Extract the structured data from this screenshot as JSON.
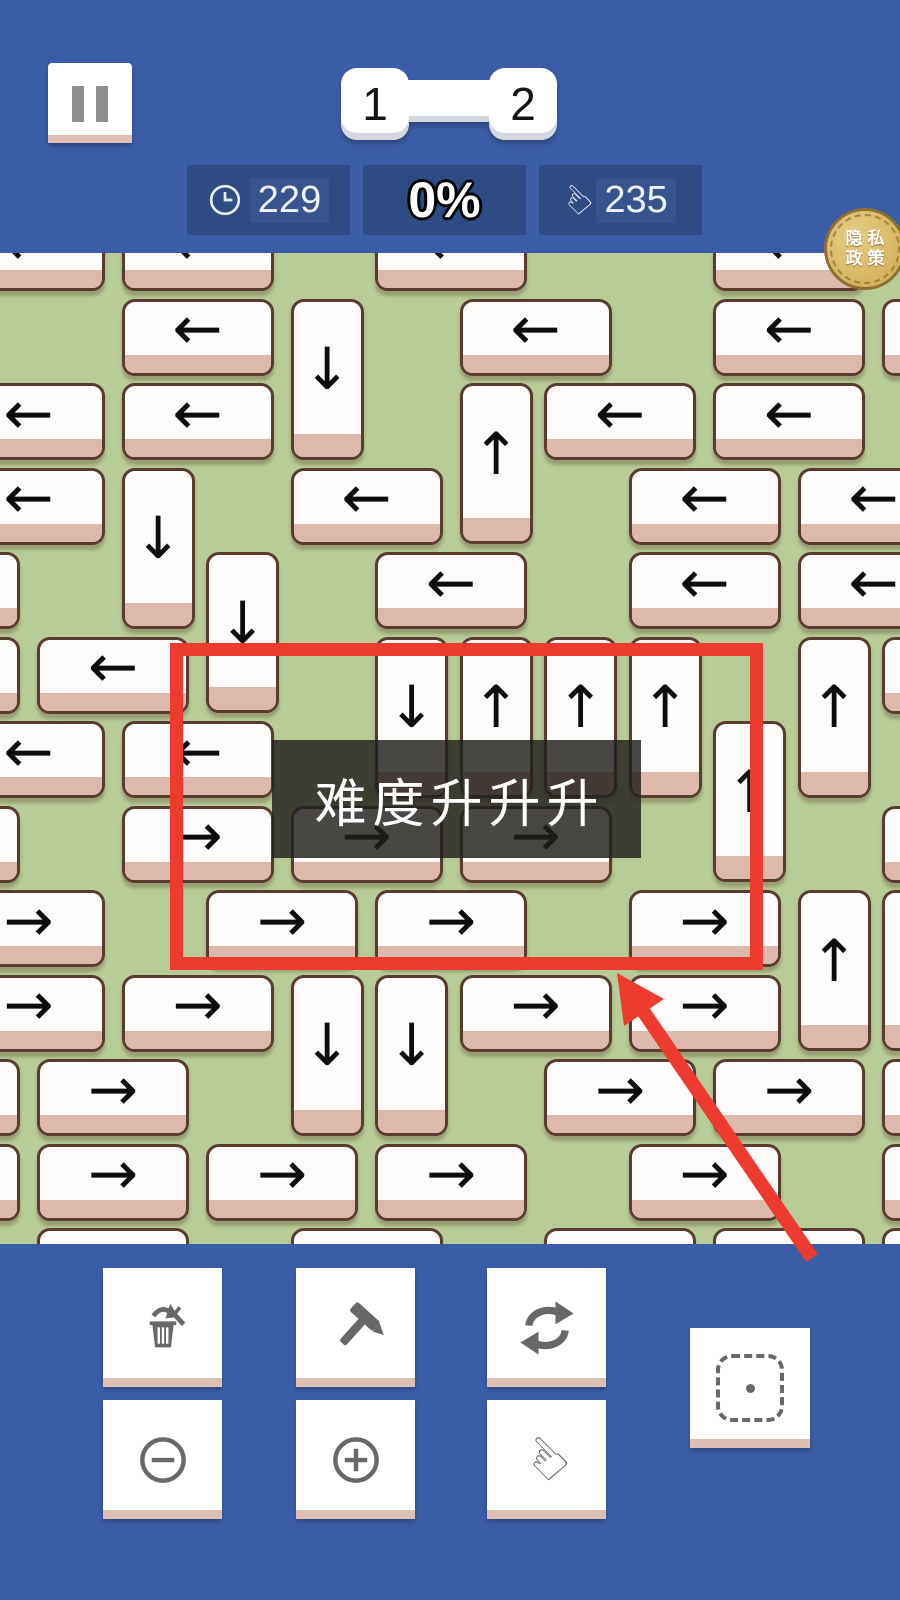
{
  "header": {
    "level_nav": {
      "current": "1",
      "next": "2"
    },
    "stats": [
      {
        "icon": "clock-icon",
        "value": "229"
      },
      {
        "icon": "none",
        "value": "0%"
      },
      {
        "icon": "hand-icon",
        "value": "235"
      }
    ],
    "privacy": {
      "line1": "隐私",
      "line2": "政策"
    }
  },
  "overlay": {
    "banner_text": "难度升升升",
    "red_rect": {
      "left": 170,
      "top": 643,
      "width": 593,
      "height": 327,
      "color": "#ed3b30"
    },
    "red_arrow": {
      "tail_x": 812,
      "tail_y": 1258,
      "tip_x": 617,
      "tip_y": 973,
      "color": "#ed3b30"
    }
  },
  "colors": {
    "header_blue": "#3b5ca6",
    "stat_panel": "#2e4c83",
    "board_green": "#b7cc97",
    "tile_white": "#fdfcfa",
    "tile_edge_pink": "#dcb9ab",
    "tile_border": "#5a3b2f",
    "annotation_red": "#ed3b30",
    "coin_gold": "#d7b96c",
    "icon_gray": "#686868"
  },
  "board": {
    "grid": {
      "origin_x": 37,
      "origin_y": 214,
      "pitch": 84.5,
      "board_top": 253,
      "h_w": 152,
      "h_h": 77,
      "v_w": 73,
      "v_h": 161
    },
    "arrow_glyphs": {
      "left": "←",
      "right": "→",
      "up": "↑",
      "down": "↓"
    },
    "tiles": [
      {
        "c": -1,
        "r": 0,
        "o": "h",
        "d": "left"
      },
      {
        "c": 1,
        "r": 0,
        "o": "h",
        "d": "left"
      },
      {
        "c": 4,
        "r": 0,
        "o": "h",
        "d": "left"
      },
      {
        "c": 8,
        "r": 0,
        "o": "h",
        "d": "left"
      },
      {
        "c": 1,
        "r": 1,
        "o": "h",
        "d": "left"
      },
      {
        "c": 3,
        "r": 1,
        "o": "v",
        "d": "down"
      },
      {
        "c": 5,
        "r": 1,
        "o": "h",
        "d": "left"
      },
      {
        "c": 8,
        "r": 1,
        "o": "h",
        "d": "left"
      },
      {
        "c": 10,
        "r": 1,
        "o": "h",
        "d": "left"
      },
      {
        "c": -1,
        "r": 2,
        "o": "h",
        "d": "left"
      },
      {
        "c": 1,
        "r": 2,
        "o": "h",
        "d": "left"
      },
      {
        "c": 5,
        "r": 2,
        "o": "v",
        "d": "up"
      },
      {
        "c": 6,
        "r": 2,
        "o": "h",
        "d": "left"
      },
      {
        "c": 8,
        "r": 2,
        "o": "h",
        "d": "left"
      },
      {
        "c": -1,
        "r": 3,
        "o": "h",
        "d": "left"
      },
      {
        "c": 1,
        "r": 3,
        "o": "v",
        "d": "down"
      },
      {
        "c": 3,
        "r": 3,
        "o": "h",
        "d": "left"
      },
      {
        "c": 7,
        "r": 3,
        "o": "h",
        "d": "left"
      },
      {
        "c": 9,
        "r": 3,
        "o": "h",
        "d": "left"
      },
      {
        "c": -2,
        "r": 4,
        "o": "h",
        "d": "left"
      },
      {
        "c": 2,
        "r": 4,
        "o": "v",
        "d": "down"
      },
      {
        "c": 4,
        "r": 4,
        "o": "h",
        "d": "left"
      },
      {
        "c": 7,
        "r": 4,
        "o": "h",
        "d": "left"
      },
      {
        "c": 9,
        "r": 4,
        "o": "h",
        "d": "left"
      },
      {
        "c": -2,
        "r": 5,
        "o": "h",
        "d": "left"
      },
      {
        "c": 0,
        "r": 5,
        "o": "h",
        "d": "left"
      },
      {
        "c": 4,
        "r": 5,
        "o": "v",
        "d": "down"
      },
      {
        "c": 5,
        "r": 5,
        "o": "v",
        "d": "up"
      },
      {
        "c": 6,
        "r": 5,
        "o": "v",
        "d": "up"
      },
      {
        "c": 7,
        "r": 5,
        "o": "v",
        "d": "up"
      },
      {
        "c": 9,
        "r": 5,
        "o": "v",
        "d": "up"
      },
      {
        "c": 10,
        "r": 5,
        "o": "h",
        "d": "left"
      },
      {
        "c": -1,
        "r": 6,
        "o": "h",
        "d": "left"
      },
      {
        "c": 1,
        "r": 6,
        "o": "h",
        "d": "left"
      },
      {
        "c": 8,
        "r": 6,
        "o": "v",
        "d": "up"
      },
      {
        "c": -2,
        "r": 7,
        "o": "h",
        "d": "right"
      },
      {
        "c": 1,
        "r": 7,
        "o": "h",
        "d": "right"
      },
      {
        "c": 3,
        "r": 7,
        "o": "h",
        "d": "right"
      },
      {
        "c": 5,
        "r": 7,
        "o": "h",
        "d": "right"
      },
      {
        "c": 10,
        "r": 7,
        "o": "h",
        "d": "right"
      },
      {
        "c": -1,
        "r": 8,
        "o": "h",
        "d": "right"
      },
      {
        "c": 2,
        "r": 8,
        "o": "h",
        "d": "right"
      },
      {
        "c": 4,
        "r": 8,
        "o": "h",
        "d": "right"
      },
      {
        "c": 7,
        "r": 8,
        "o": "h",
        "d": "right"
      },
      {
        "c": 9,
        "r": 8,
        "o": "v",
        "d": "up"
      },
      {
        "c": 10,
        "r": 8,
        "o": "v",
        "d": "up"
      },
      {
        "c": -1,
        "r": 9,
        "o": "h",
        "d": "right"
      },
      {
        "c": 1,
        "r": 9,
        "o": "h",
        "d": "right"
      },
      {
        "c": 3,
        "r": 9,
        "o": "v",
        "d": "down"
      },
      {
        "c": 4,
        "r": 9,
        "o": "v",
        "d": "down"
      },
      {
        "c": 5,
        "r": 9,
        "o": "h",
        "d": "right"
      },
      {
        "c": 7,
        "r": 9,
        "o": "h",
        "d": "right"
      },
      {
        "c": -2,
        "r": 10,
        "o": "h",
        "d": "right"
      },
      {
        "c": 0,
        "r": 10,
        "o": "h",
        "d": "right"
      },
      {
        "c": 6,
        "r": 10,
        "o": "h",
        "d": "right"
      },
      {
        "c": 8,
        "r": 10,
        "o": "h",
        "d": "right"
      },
      {
        "c": 10,
        "r": 10,
        "o": "h",
        "d": "right"
      },
      {
        "c": -2,
        "r": 11,
        "o": "h",
        "d": "right"
      },
      {
        "c": 0,
        "r": 11,
        "o": "h",
        "d": "right"
      },
      {
        "c": 2,
        "r": 11,
        "o": "h",
        "d": "right"
      },
      {
        "c": 4,
        "r": 11,
        "o": "h",
        "d": "right"
      },
      {
        "c": 7,
        "r": 11,
        "o": "h",
        "d": "right"
      },
      {
        "c": 10,
        "r": 11,
        "o": "h",
        "d": "right"
      },
      {
        "c": 0,
        "r": 12,
        "o": "h",
        "d": "right"
      },
      {
        "c": 3,
        "r": 12,
        "o": "h",
        "d": "right"
      },
      {
        "c": 6,
        "r": 12,
        "o": "h",
        "d": "right"
      },
      {
        "c": 8,
        "r": 12,
        "o": "h",
        "d": "right"
      },
      {
        "c": 10,
        "r": 12,
        "o": "h",
        "d": "right"
      }
    ]
  },
  "toolbar": {
    "buttons": [
      {
        "name": "discard-tile-button",
        "icon": "trash-arrow-icon"
      },
      {
        "name": "hammer-button",
        "icon": "hammer-icon"
      },
      {
        "name": "swap-button",
        "icon": "swap-icon"
      },
      {
        "name": "zoom-out-button",
        "icon": "minus-circle-icon"
      },
      {
        "name": "zoom-in-button",
        "icon": "plus-circle-icon"
      },
      {
        "name": "tap-mode-button",
        "icon": "hand-icon"
      },
      {
        "name": "select-area-button",
        "icon": "select-frame-icon"
      }
    ]
  }
}
